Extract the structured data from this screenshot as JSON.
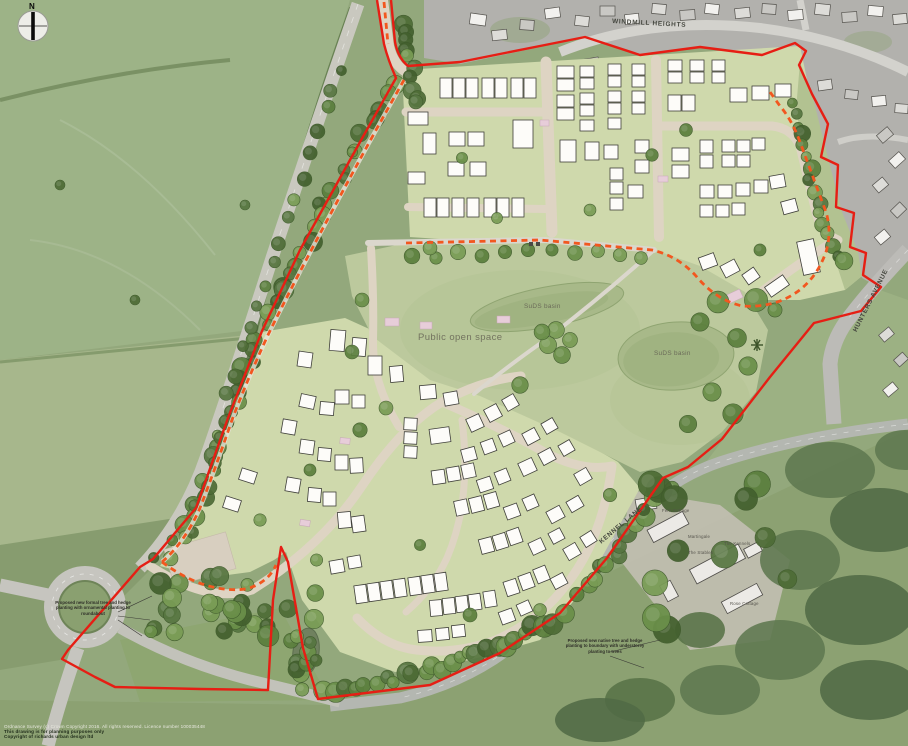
{
  "north_arrow": {
    "label": "N"
  },
  "street_labels": {
    "windmill_heights": "WINDMILL HEIGHTS",
    "hunters_avenue": "HUNTERS AVENUE",
    "kennel_lane": "KENNEL LANE"
  },
  "site_labels": {
    "public_open_space": "Public open space",
    "suds_basin_north": "SuDS basin",
    "suds_basin_east": "SuDS basin"
  },
  "annotations": {
    "roundabout_note": "Proposed new formal tree and hedge planting with ornamental planting to roundabout",
    "boundary_note": "Proposed new native tree and hedge planting to boundary with understorey planting to trees"
  },
  "property_labels": {
    "fern_cottage": "Fern Cottage",
    "martingale": "Martingale",
    "the_stables": "The Stables",
    "the_kennels": "The Kennels",
    "rose_cottage": "Rose Cottage"
  },
  "footer": {
    "line1": "Ordnance Survey (c) Crown Copyright 2016. All rights reserved. Licence number 100035448",
    "line2": "This drawing is for planning purposes only",
    "line3": "Copyright of richards urban design ltd"
  },
  "colors": {
    "site_boundary_red": "#e61e14",
    "footpath_orange": "#f2571f",
    "open_space_green": "#bcc99d",
    "plot_green": "#cfd9ac",
    "road_beige": "#ded4c3",
    "house_white": "#fdfcf9",
    "aerial_field_green": "#93a87c",
    "existing_estate_grey": "#b2b1ad"
  }
}
